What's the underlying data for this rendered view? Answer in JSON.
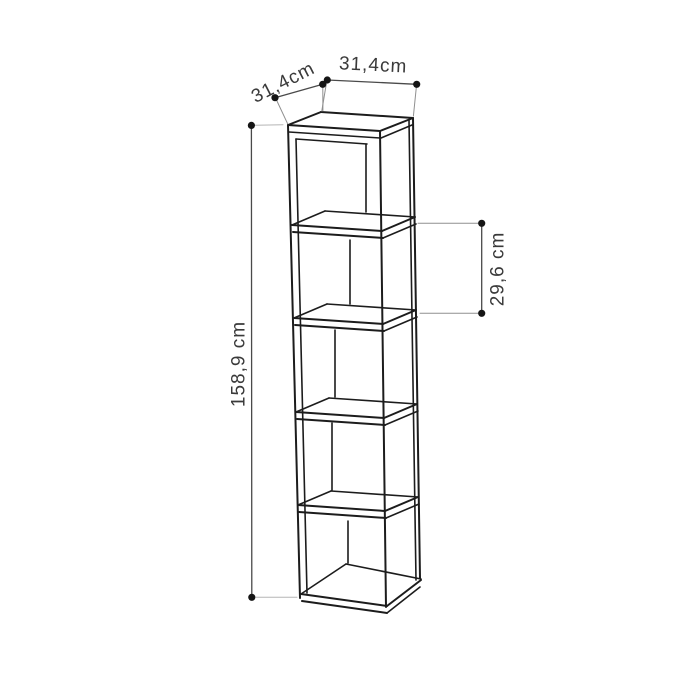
{
  "diagram": {
    "kind": "furniture dimension line drawing",
    "subject": "tall narrow 5-cube open shelf column shown in three-quarter view",
    "shelf_count": 5,
    "colors": {
      "background": "#ffffff",
      "artwork_line": "#1c1c1c",
      "dimension_line": "#4a4a4a",
      "label_text": "#3a3a3a"
    },
    "dimensions": {
      "width_top": {
        "label": "31,4cm",
        "value": "31,4",
        "unit": "cm",
        "measures": "top width",
        "placement": "top, horizontal"
      },
      "depth_top": {
        "label": "31,4cm",
        "value": "31,4",
        "unit": "cm",
        "measures": "top depth",
        "placement": "top-left, diagonal along the top left edge"
      },
      "height_left": {
        "label": "158,9 cm",
        "value": "158,9",
        "unit": "cm",
        "measures": "overall height",
        "placement": "left side, vertical, reads bottom-to-top"
      },
      "compartment_right": {
        "label": "29,6 cm",
        "value": "29,6",
        "unit": "cm",
        "measures": "height of one shelf compartment",
        "placement": "right side, vertical, reads bottom-to-top"
      }
    }
  }
}
